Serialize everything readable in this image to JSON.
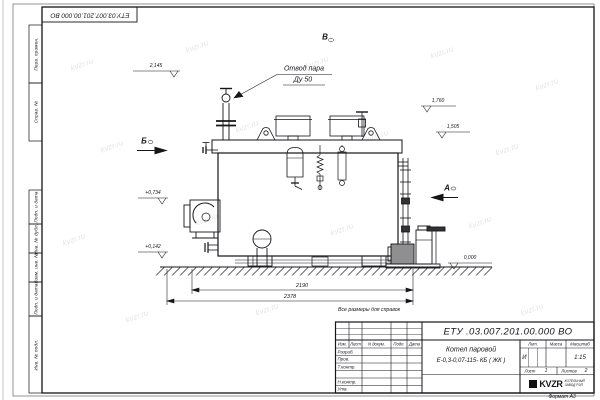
{
  "sheet": {
    "watermark": "kvzr.ru",
    "format_note": "Формат А3",
    "reference_note": "Все размеры для справок",
    "corner_designation": "ЕТУ.03.007.201.00.000  ВО"
  },
  "margin": {
    "perv_primen": "Перв. примен.",
    "sprav_no": "Справ. №",
    "podp_data_1": "Подп. и дата",
    "inv_dubl": "Инв. № дубл.",
    "vzam_inv": "Взам. инв. №",
    "podp_data_2": "Подп. и дата",
    "inv_podl": "Инв. № подл."
  },
  "annotations": {
    "callout_line1": "Отвод пара",
    "callout_line2": "Ду 50",
    "view_top": "В",
    "view_left": "Б",
    "view_right": "А",
    "elev_1": "2,145",
    "elev_2": "1,760",
    "elev_3": "1,505",
    "elev_4": "+0,734",
    "elev_5": "+0,142",
    "elev_6": "0,000",
    "dim_inner": "2190",
    "dim_outer": "2378"
  },
  "title_block": {
    "designation": "ЕТУ .03.007.201.00.000  ВО",
    "name_line1": "Котел паровой",
    "name_line2": "Е-0,3-0,07-115- КБ ( ЖК )",
    "col_izm": "Изм.",
    "col_list": "Лист",
    "col_ndokum": "N докум.",
    "col_podp": "Подп.",
    "col_data": "Дата",
    "row_razrab": "Разраб.",
    "row_prov": "Пров.",
    "row_tkontr": "Т.контр.",
    "row_nkontr": "Н.контр.",
    "row_utv": "Утв.",
    "lit_label": "Лит.",
    "massa_label": "Масса",
    "masshtab_label": "Масштаб",
    "lit_value": "И",
    "scale_value": "1:15",
    "list_label": "Лист",
    "list_value": "1",
    "listov_label": "Листов",
    "listov_value": "2",
    "logo_word": "KVZR",
    "logo_caption_line1": "КОТЕЛЬНЫЙ",
    "logo_caption_line2": "ЗАВОД РЭП"
  }
}
